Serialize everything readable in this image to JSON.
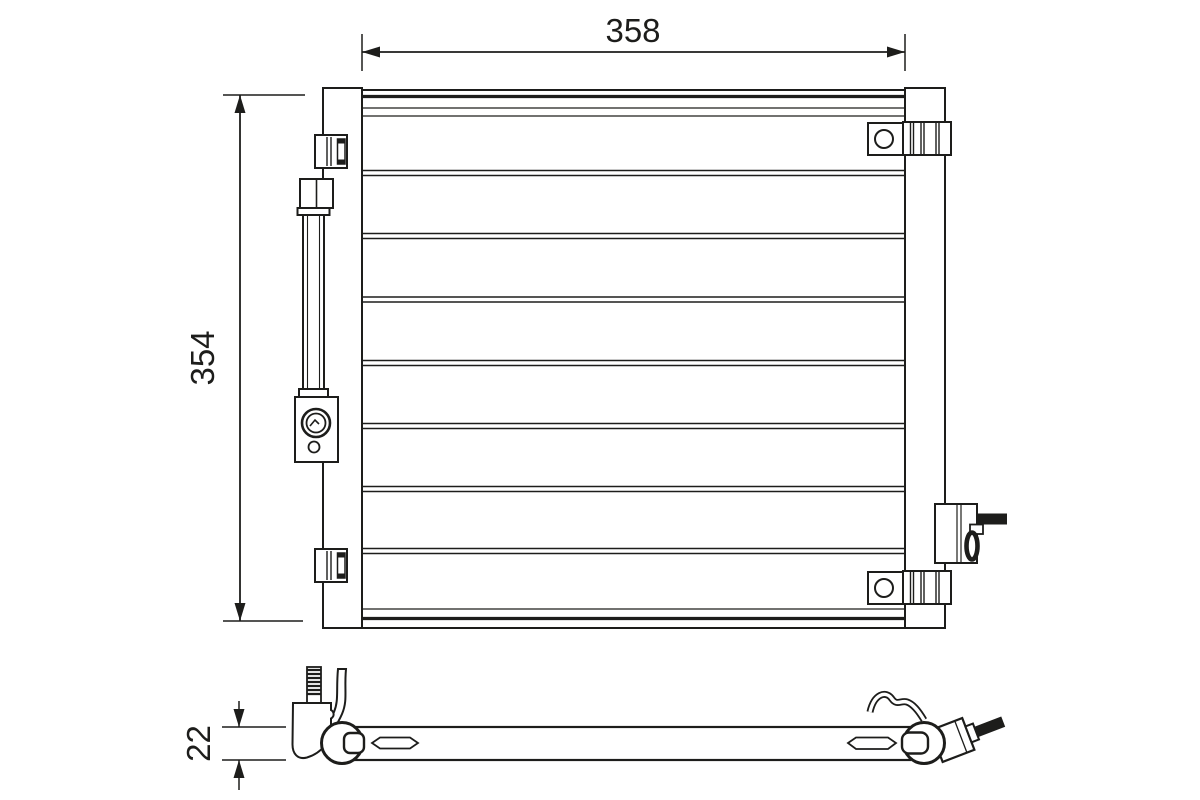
{
  "drawing": {
    "background": "#ffffff",
    "line_color": "#1d1d1b",
    "dimensions": {
      "width": {
        "value": "358"
      },
      "height": {
        "value": "354"
      },
      "depth": {
        "value": "22"
      }
    }
  }
}
